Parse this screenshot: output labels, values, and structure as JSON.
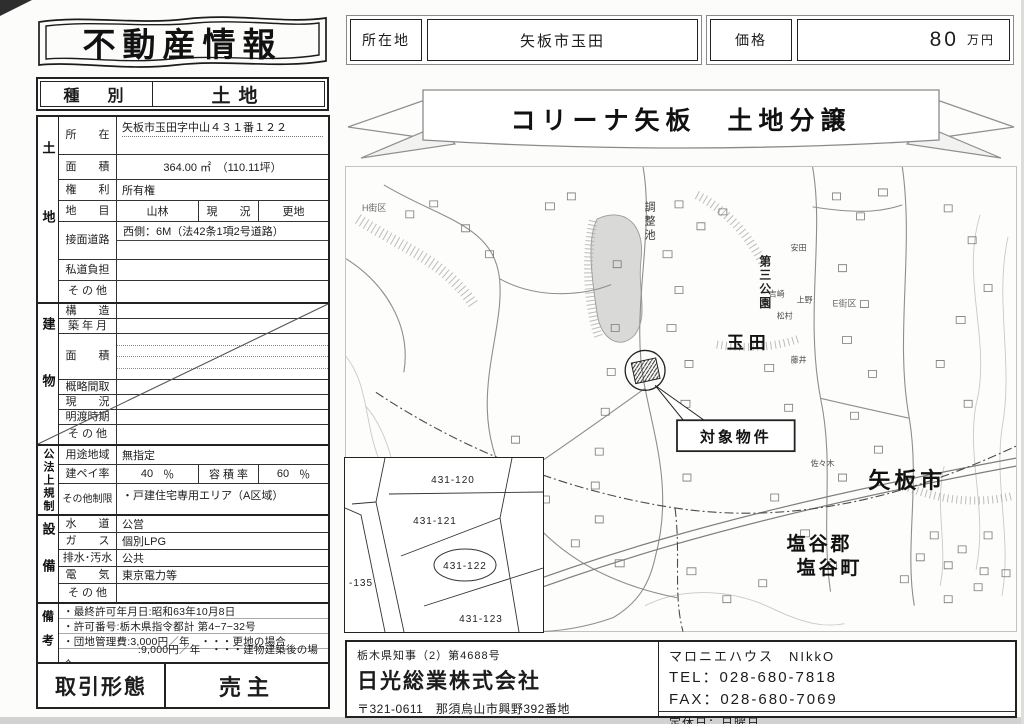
{
  "title": "不動産情報",
  "type_row": {
    "label": "種　別",
    "value": "土地"
  },
  "location_row": {
    "label": "所在地",
    "value": "矢板市玉田"
  },
  "price_row": {
    "label": "価格",
    "value": "80",
    "unit": "万円"
  },
  "banner": {
    "title": "コリーナ矢板　土地分譲"
  },
  "land": {
    "group": "土地",
    "rows": {
      "shozai": {
        "label": "所　　在",
        "value": "矢板市玉田字中山４３１番１２２"
      },
      "menseki": {
        "label": "面　　積",
        "value": "364.00 ㎡　（110.11坪）"
      },
      "kenri": {
        "label": "権　　利",
        "value": "所有権"
      },
      "chimoku": {
        "label": "地　　目",
        "value": "山林",
        "sub_label": "現　　況",
        "sub_value": "更地"
      },
      "setsumen": {
        "label": "接面道路",
        "value": "西側：6M（法42条1項2号道路）"
      },
      "shido": {
        "label": "私道負担",
        "value": ""
      },
      "sonota": {
        "label": "そ の 他",
        "value": ""
      }
    }
  },
  "building": {
    "group": "建物",
    "rows": {
      "kozo": {
        "label": "構　　造"
      },
      "chiku": {
        "label": "築 年 月"
      },
      "menseki": {
        "label": "面　　積"
      },
      "madori": {
        "label": "概略間取"
      },
      "genkyo": {
        "label": "現　　況"
      },
      "akewatashi": {
        "label": "明渡時期"
      },
      "sonota": {
        "label": "そ の 他"
      }
    }
  },
  "regulation": {
    "group": "公法上規制",
    "rows": {
      "yoto": {
        "label": "用途地域",
        "value": "無指定"
      },
      "kenpei": {
        "label": "建ペイ率",
        "value": "40",
        "unit": "％",
        "sub_label": "容 積 率",
        "sub_value": "60",
        "sub_unit": "％"
      },
      "seigen": {
        "label": "その他制限",
        "value": "・戸建住宅専用エリア（A区域）"
      }
    }
  },
  "utilities": {
    "group": "設備",
    "rows": {
      "suido": {
        "label": "水　　道",
        "value": "公営"
      },
      "gas": {
        "label": "ガ　　ス",
        "value": "個別LPG"
      },
      "haisui": {
        "label": "排水･汚水",
        "value": "公共"
      },
      "denki": {
        "label": "電　　気",
        "value": "東京電力等"
      },
      "sonota": {
        "label": "そ の 他",
        "value": ""
      }
    }
  },
  "remarks": {
    "group": "備考",
    "lines": [
      "・最終許可年月日:昭和63年10月8日",
      "・許可番号:栃木県指令都計 第4−7−32号",
      "・団地管理費:3,000円／年　・・・更地の場合",
      "　　　　　　　:9,000円／年　・・・建物建築後の場合"
    ]
  },
  "transaction": {
    "label": "取引形態",
    "value": "売主"
  },
  "map": {
    "labels": {
      "h_block": "H街区",
      "pond": "調整池",
      "park": "第三公園",
      "e_block": "E街区",
      "tamada": "玉田",
      "target": "対象物件",
      "yaita_city": "矢板市",
      "shioya_gun": "塩谷郡",
      "shioya_machi": "塩谷町"
    },
    "households": [
      "安田",
      "吉崎",
      "上野",
      "松村",
      "藤井",
      "佐々木"
    ],
    "inset": {
      "p120": "431-120",
      "p121": "431-121",
      "p122": "431-122",
      "p123": "431-123",
      "edge": "-135"
    }
  },
  "company": {
    "license": "栃木県知事（2）第4688号",
    "name": "日光総業株式会社",
    "address": "〒321-0611　那須烏山市興野392番地",
    "brand": "マロニエハウス　NIkkO",
    "tel": "TEL：028-680-7818",
    "fax": "FAX：028-680-7069",
    "holiday": "定休日：日曜日"
  }
}
